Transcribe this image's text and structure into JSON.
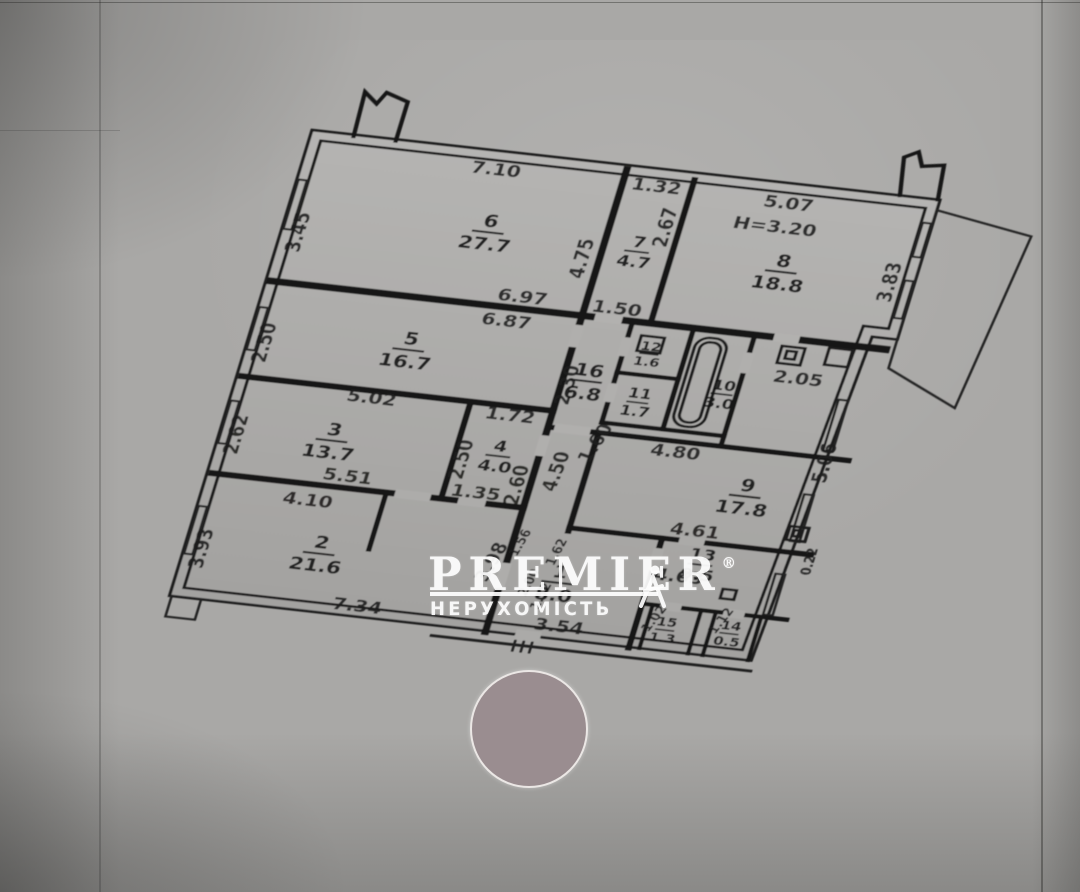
{
  "watermark": {
    "brand": "PREMIER",
    "registered": "®",
    "subtitle": "НЕРУХОМІСТЬ"
  },
  "rooms": {
    "r1": {
      "num": "1",
      "area": "8.0"
    },
    "r2": {
      "num": "2",
      "area": "21.6"
    },
    "r3": {
      "num": "3",
      "area": "13.7"
    },
    "r4": {
      "num": "4",
      "area": "4.0"
    },
    "r5": {
      "num": "5",
      "area": "16.7"
    },
    "r6": {
      "num": "6",
      "area": "27.7"
    },
    "r7": {
      "num": "7",
      "area": "4.7"
    },
    "r8": {
      "num": "8",
      "area": "18.8"
    },
    "r9": {
      "num": "9",
      "area": "17.8"
    },
    "r10": {
      "num": "10",
      "area": "3.0"
    },
    "r11": {
      "num": "11",
      "area": "1.7"
    },
    "r12": {
      "num": "12",
      "area": "1.6"
    },
    "r13": {
      "num": "13",
      "area": "9.5"
    },
    "r14": {
      "num": "14",
      "area": "0.5"
    },
    "r15": {
      "num": "15",
      "area": "1.3"
    },
    "r16": {
      "num": "16",
      "area": "6.8"
    }
  },
  "dims": {
    "v710": "7.10",
    "v345": "3.45",
    "v697": "6.97",
    "v687": "6.87",
    "v475": "4.75",
    "v132": "1.32",
    "v267": "2.67",
    "v507": "5.07",
    "h320": "H=3.20",
    "v383": "3.83",
    "v250a": "2.50",
    "v502": "5.02",
    "v262": "2.62",
    "v551": "5.51",
    "v172": "1.72",
    "v250b": "2.50",
    "v260": "2.60",
    "v135": "1.35",
    "v410": "4.10",
    "v393": "3.93",
    "v734": "7.34",
    "v230": "2.30",
    "v150": "1.50",
    "v450": "4.50",
    "v160": "1.60",
    "v480": "4.80",
    "v205": "2.05",
    "v506": "5.06",
    "v022": "0.22",
    "v461": "4.61",
    "v463": "4.63",
    "v354": "3.54",
    "v398": "3.98",
    "v156": "1.56",
    "v200": "2.00",
    "v162": "1.62",
    "v152": "1.52",
    "v102": "1.02",
    "v112": "1.12"
  },
  "colors": {
    "paper": "#a9a8a6",
    "ink": "#1c1c1c",
    "stamp_circle": "#9a8d90",
    "watermark": "#ffffff"
  }
}
